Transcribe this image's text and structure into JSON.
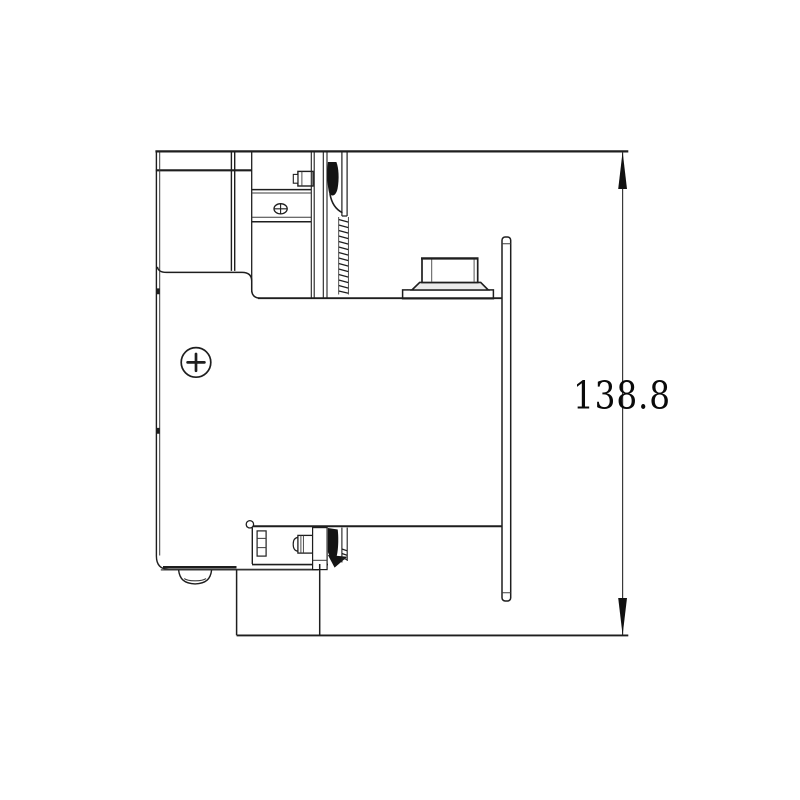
{
  "page": {
    "background": "#ffffff"
  },
  "drawing": {
    "line_color": "#1e1e1e",
    "contact_fill": "#141414",
    "dimension": {
      "value": "138.8"
    }
  }
}
